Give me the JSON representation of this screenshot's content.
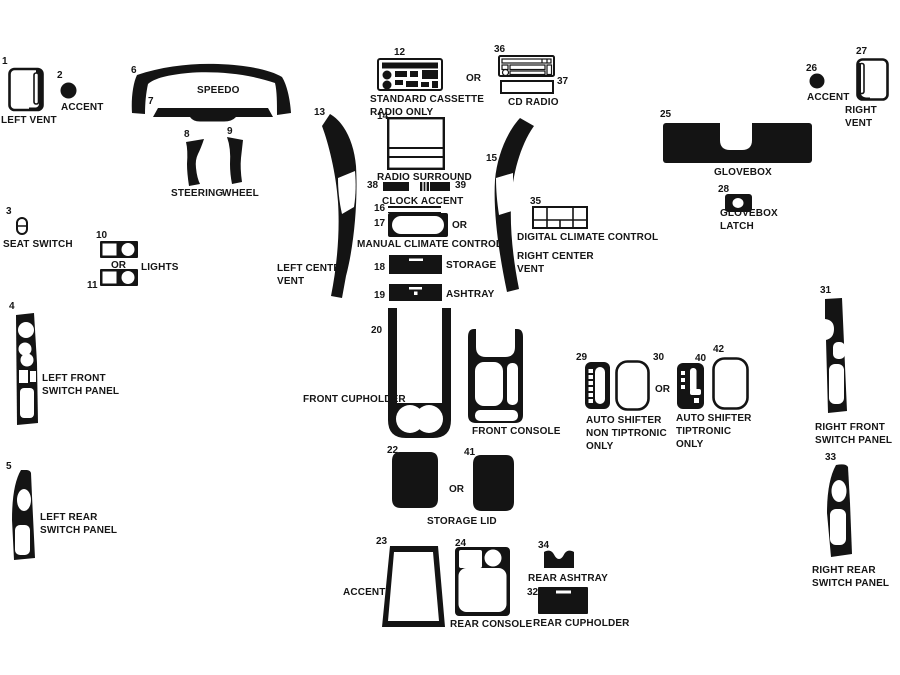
{
  "or": "OR",
  "parts": {
    "p1": {
      "num": "1",
      "label": "LEFT VENT"
    },
    "p2": {
      "num": "2",
      "label": "ACCENT"
    },
    "p3": {
      "num": "3",
      "label": "SEAT SWITCH"
    },
    "p4": {
      "num": "4",
      "label": "LEFT FRONT\nSWITCH PANEL"
    },
    "p5": {
      "num": "5",
      "label": "LEFT REAR\nSWITCH PANEL"
    },
    "p6": {
      "num": "6",
      "label": "SPEEDO"
    },
    "p7": {
      "num": "7"
    },
    "p8": {
      "num": "8",
      "label": "STEERING"
    },
    "p9": {
      "num": "9",
      "label": "WHEEL"
    },
    "p10": {
      "num": "10"
    },
    "p11": {
      "num": "11"
    },
    "lights": {
      "label": "LIGHTS"
    },
    "p12": {
      "num": "12",
      "label": "STANDARD CASSETTE\nRADIO ONLY"
    },
    "p13": {
      "num": "13",
      "label": "LEFT CENTER\nVENT"
    },
    "p14": {
      "num": "14",
      "label": "RADIO SURROUND"
    },
    "p15": {
      "num": "15",
      "label": "RIGHT CENTER\nVENT"
    },
    "p16": {
      "num": "16"
    },
    "p17": {
      "num": "17",
      "label": "MANUAL CLIMATE CONTROL"
    },
    "p18": {
      "num": "18",
      "label": "STORAGE"
    },
    "p19": {
      "num": "19",
      "label": "ASHTRAY"
    },
    "p20": {
      "num": "20",
      "label": "FRONT CUPHOLDER"
    },
    "p21": {
      "num": "21",
      "label": "FRONT CONSOLE"
    },
    "p22": {
      "num": "22"
    },
    "p23": {
      "num": "23",
      "label": "ACCENT"
    },
    "p24": {
      "num": "24",
      "label": "REAR CONSOLE"
    },
    "p25": {
      "num": "25",
      "label": "GLOVEBOX"
    },
    "p26": {
      "num": "26",
      "label": "ACCENT"
    },
    "p27": {
      "num": "27",
      "label": "RIGHT VENT"
    },
    "p28": {
      "num": "28",
      "label": "GLOVEBOX\nLATCH"
    },
    "p29": {
      "num": "29"
    },
    "p30": {
      "num": "30"
    },
    "p31": {
      "num": "31",
      "label": "RIGHT FRONT\nSWITCH PANEL"
    },
    "p32": {
      "num": "32",
      "label": "REAR CUPHOLDER"
    },
    "p33": {
      "num": "33",
      "label": "RIGHT REAR\nSWITCH PANEL"
    },
    "p34": {
      "num": "34",
      "label": "REAR ASHTRAY"
    },
    "p35": {
      "num": "35",
      "label": "DIGITAL CLIMATE CONTROL"
    },
    "p36": {
      "num": "36"
    },
    "p37": {
      "num": "37"
    },
    "p38": {
      "num": "38"
    },
    "p39": {
      "num": "39"
    },
    "p40": {
      "num": "40"
    },
    "p41": {
      "num": "41"
    },
    "p42": {
      "num": "42"
    },
    "cd_radio": {
      "label": "CD RADIO"
    },
    "clock_accent": {
      "label": "CLOCK ACCENT"
    },
    "storage_lid": {
      "label": "STORAGE LID"
    },
    "shifter_non_tip": {
      "label": "AUTO SHIFTER\nNON TIPTRONIC\nONLY"
    },
    "shifter_tip": {
      "label": "AUTO SHIFTER\nTIPTRONIC\nONLY"
    }
  }
}
